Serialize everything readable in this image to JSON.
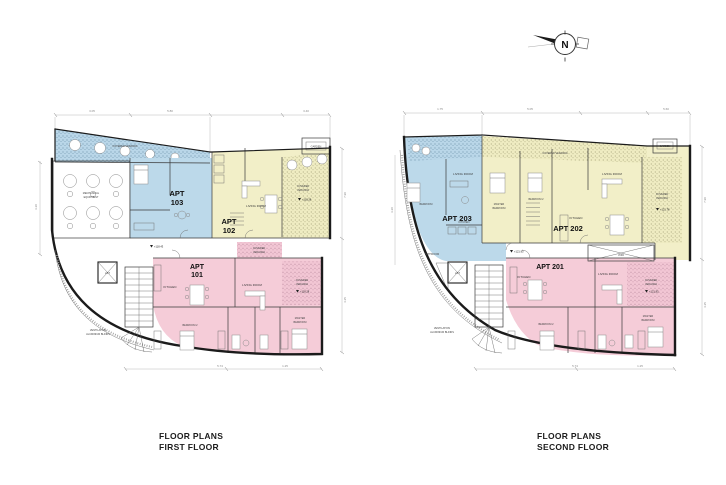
{
  "sheet": {
    "bg": "#ffffff"
  },
  "north": {
    "label": "N"
  },
  "titles": {
    "first": {
      "line1": "FLOOR PLANS",
      "line2": "FIRST FLOOR"
    },
    "second": {
      "line1": "FLOOR PLANS",
      "line2": "SECOND FLOOR"
    }
  },
  "apartments": {
    "a101_1": "APT",
    "a101_2": "101",
    "a102_1": "APT",
    "a102_2": "102",
    "a103_1": "APT",
    "a103_2": "103",
    "a201": "APT 201",
    "a202": "APT 202",
    "a203": "APT 203"
  },
  "labels": {
    "cv": "COVERED VERANDA",
    "covered": "COVERED",
    "veranda": "VERANDA",
    "living": "LIVING ROOM",
    "kitchen": "KITCHEN",
    "bedroom": "BEDROOM",
    "bedroom2": "BEDROOM 2",
    "master1": "MASTER",
    "master2": "BEDROOM",
    "mech1": "MECHANICAL",
    "mech2": "EQUIPMENT",
    "lift": "LIFT",
    "void": "VOID",
    "garden": "GARDEN",
    "bathroom": "BATHROOM",
    "vent1": "VENTILATION",
    "vent2": "ALUMINIUM BLINDS"
  },
  "levels": {
    "l1": "+118.28",
    "l2": "+118.43",
    "l3": "+121.78",
    "l4": "+121.93"
  },
  "dims": {
    "d1": "3.05",
    "d2": "5.80",
    "d3": "3.40",
    "d4": "1.75",
    "d5": "5.05",
    "d6": "5.60",
    "d7": "5.74",
    "d8": "1.25",
    "d9": "7.90",
    "d10": "4.25",
    "d11": "3.20"
  },
  "colors": {
    "blue": "#bcd9ea",
    "yellow": "#f2efc8",
    "pink": "#f5ccd8",
    "wall": "#1b1b1b"
  }
}
